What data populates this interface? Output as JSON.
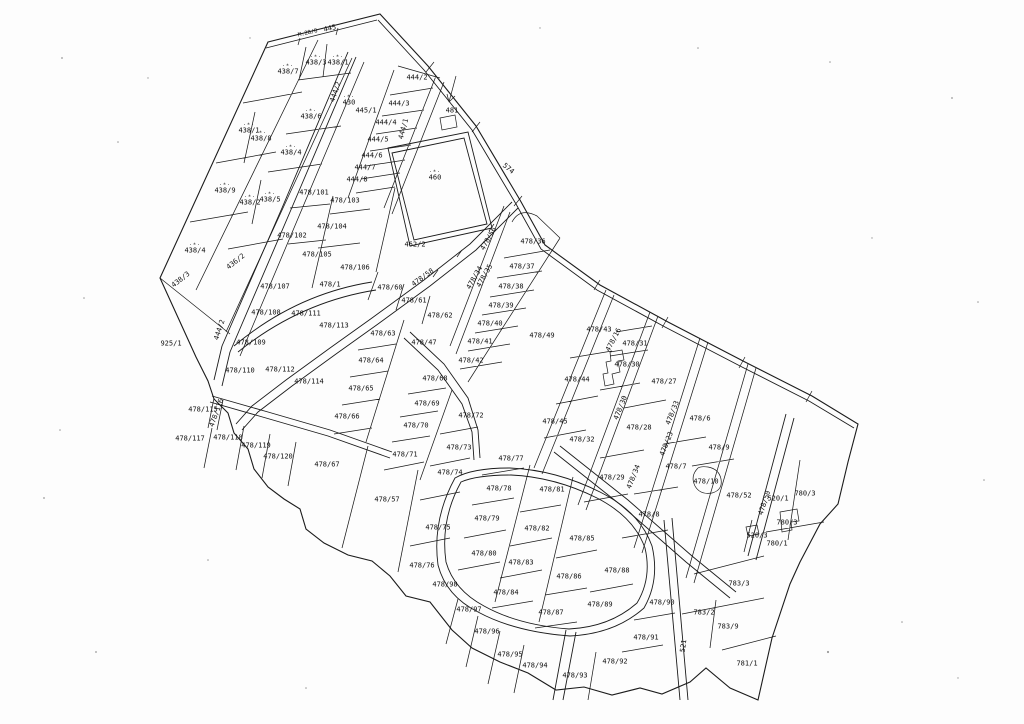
{
  "map": {
    "type": "cadastral-parcel-plan",
    "canvas": {
      "width": 1024,
      "height": 724
    },
    "colors": {
      "background": "#fdfdfd",
      "line": "#1b1b1b",
      "label": "#101010"
    },
    "tree_symbol": "·*·",
    "labels": [
      {
        "t": "445",
        "x": 330,
        "y": 29,
        "r": -13
      },
      {
        "t": "M.28/8",
        "x": 308,
        "y": 34,
        "r": -13,
        "fs": 5.5
      },
      {
        "t": "438/3",
        "x": 316,
        "y": 61,
        "s": 1
      },
      {
        "t": "438/1",
        "x": 338,
        "y": 61,
        "s": 1
      },
      {
        "t": "438/7",
        "x": 288,
        "y": 70,
        "s": 1
      },
      {
        "t": "444/2",
        "x": 336,
        "y": 92,
        "r": -72
      },
      {
        "t": "430",
        "x": 349,
        "y": 101,
        "s": 1
      },
      {
        "t": "438/6",
        "x": 311,
        "y": 115,
        "s": 1
      },
      {
        "t": "445/1",
        "x": 366,
        "y": 111
      },
      {
        "t": "444/2",
        "x": 417,
        "y": 78
      },
      {
        "t": "444/3",
        "x": 399,
        "y": 104
      },
      {
        "t": "444/1",
        "x": 404,
        "y": 129,
        "r": -75
      },
      {
        "t": "444/4",
        "x": 386,
        "y": 123
      },
      {
        "t": "444/5",
        "x": 378,
        "y": 140
      },
      {
        "t": "444/6",
        "x": 372,
        "y": 156
      },
      {
        "t": "444/7",
        "x": 365,
        "y": 168
      },
      {
        "t": "444/8",
        "x": 357,
        "y": 180
      },
      {
        "t": "438/1",
        "x": 249,
        "y": 129,
        "s": 1
      },
      {
        "t": "438/8",
        "x": 261,
        "y": 137,
        "s": 1
      },
      {
        "t": "438/4",
        "x": 291,
        "y": 151,
        "s": 1
      },
      {
        "t": "438/9",
        "x": 225,
        "y": 189,
        "s": 1
      },
      {
        "t": "438/5",
        "x": 270,
        "y": 198,
        "s": 1
      },
      {
        "t": "438/2",
        "x": 250,
        "y": 201,
        "s": 1
      },
      {
        "t": "438/4",
        "x": 195,
        "y": 249,
        "s": 1
      },
      {
        "t": "436/2",
        "x": 236,
        "y": 262,
        "r": -38
      },
      {
        "t": "438/3",
        "x": 181,
        "y": 280,
        "r": -38
      },
      {
        "t": "481",
        "x": 452,
        "y": 111
      },
      {
        "t": "574",
        "x": 508,
        "y": 169,
        "r": 40
      },
      {
        "t": "460",
        "x": 435,
        "y": 176,
        "s": 1
      },
      {
        "t": "462/2",
        "x": 415,
        "y": 245
      },
      {
        "t": "478/101",
        "x": 314,
        "y": 193
      },
      {
        "t": "478/103",
        "x": 345,
        "y": 201
      },
      {
        "t": "478/104",
        "x": 332,
        "y": 227
      },
      {
        "t": "478/102",
        "x": 292,
        "y": 236
      },
      {
        "t": "478/105",
        "x": 317,
        "y": 255
      },
      {
        "t": "478/106",
        "x": 355,
        "y": 268
      },
      {
        "t": "478/56",
        "x": 489,
        "y": 239,
        "r": -60
      },
      {
        "t": "478/34",
        "x": 475,
        "y": 278,
        "r": -60
      },
      {
        "t": "478/35",
        "x": 485,
        "y": 276,
        "r": -60
      },
      {
        "t": "478/58",
        "x": 423,
        "y": 278,
        "r": -36
      },
      {
        "t": "478/36",
        "x": 533,
        "y": 242
      },
      {
        "t": "478/37",
        "x": 522,
        "y": 267
      },
      {
        "t": "478/38",
        "x": 511,
        "y": 287
      },
      {
        "t": "478/39",
        "x": 501,
        "y": 306
      },
      {
        "t": "478/40",
        "x": 490,
        "y": 324
      },
      {
        "t": "478/41",
        "x": 480,
        "y": 342
      },
      {
        "t": "478/42",
        "x": 471,
        "y": 361
      },
      {
        "t": "478/49",
        "x": 542,
        "y": 336
      },
      {
        "t": "478/43",
        "x": 599,
        "y": 330
      },
      {
        "t": "478/16",
        "x": 614,
        "y": 340,
        "r": -62
      },
      {
        "t": "478/31",
        "x": 635,
        "y": 344
      },
      {
        "t": "478/30",
        "x": 627,
        "y": 365
      },
      {
        "t": "478/27",
        "x": 664,
        "y": 382
      },
      {
        "t": "478/44",
        "x": 577,
        "y": 380
      },
      {
        "t": "478/28",
        "x": 639,
        "y": 428
      },
      {
        "t": "478/45",
        "x": 555,
        "y": 422
      },
      {
        "t": "478/32",
        "x": 582,
        "y": 440
      },
      {
        "t": "478/29",
        "x": 612,
        "y": 478
      },
      {
        "t": "478/30",
        "x": 621,
        "y": 408,
        "r": -68
      },
      {
        "t": "478/33",
        "x": 673,
        "y": 413,
        "r": -68
      },
      {
        "t": "478/23",
        "x": 667,
        "y": 444,
        "r": -68
      },
      {
        "t": "478/34",
        "x": 634,
        "y": 477,
        "r": -68
      },
      {
        "t": "478/6",
        "x": 700,
        "y": 419
      },
      {
        "t": "478/9",
        "x": 719,
        "y": 448
      },
      {
        "t": "478/7",
        "x": 676,
        "y": 467
      },
      {
        "t": "478/10",
        "x": 706,
        "y": 482
      },
      {
        "t": "478/8",
        "x": 649,
        "y": 515
      },
      {
        "t": "478/52",
        "x": 739,
        "y": 496
      },
      {
        "t": "478/50",
        "x": 765,
        "y": 503,
        "r": -72
      },
      {
        "t": "520/1",
        "x": 778,
        "y": 499
      },
      {
        "t": "780/3",
        "x": 805,
        "y": 494
      },
      {
        "t": "780/3",
        "x": 787,
        "y": 523
      },
      {
        "t": "780/1",
        "x": 777,
        "y": 544
      },
      {
        "t": "520/3",
        "x": 757,
        "y": 536
      },
      {
        "t": "925/1",
        "x": 171,
        "y": 344
      },
      {
        "t": "444/2",
        "x": 220,
        "y": 330,
        "r": -72
      },
      {
        "t": "478/1",
        "x": 330,
        "y": 285
      },
      {
        "t": "478/60",
        "x": 390,
        "y": 288
      },
      {
        "t": "478/61",
        "x": 414,
        "y": 301
      },
      {
        "t": "478/62",
        "x": 440,
        "y": 316
      },
      {
        "t": "478/107",
        "x": 275,
        "y": 287
      },
      {
        "t": "478/108",
        "x": 266,
        "y": 313
      },
      {
        "t": "478/111",
        "x": 306,
        "y": 314
      },
      {
        "t": "478/113",
        "x": 334,
        "y": 326
      },
      {
        "t": "478/109",
        "x": 251,
        "y": 343
      },
      {
        "t": "478/63",
        "x": 383,
        "y": 334
      },
      {
        "t": "478/64",
        "x": 371,
        "y": 361
      },
      {
        "t": "478/110",
        "x": 240,
        "y": 371
      },
      {
        "t": "478/112",
        "x": 280,
        "y": 370
      },
      {
        "t": "478/114",
        "x": 309,
        "y": 382
      },
      {
        "t": "478/65",
        "x": 361,
        "y": 389
      },
      {
        "t": "478/47",
        "x": 424,
        "y": 343
      },
      {
        "t": "478/68",
        "x": 435,
        "y": 379
      },
      {
        "t": "478/69",
        "x": 427,
        "y": 404
      },
      {
        "t": "478/70",
        "x": 416,
        "y": 426
      },
      {
        "t": "478/72",
        "x": 471,
        "y": 416
      },
      {
        "t": "478/66",
        "x": 347,
        "y": 417
      },
      {
        "t": "478/115",
        "x": 203,
        "y": 410
      },
      {
        "t": "478/116",
        "x": 217,
        "y": 413,
        "r": -70
      },
      {
        "t": "478/117",
        "x": 190,
        "y": 439
      },
      {
        "t": "478/118",
        "x": 228,
        "y": 438
      },
      {
        "t": "478/119",
        "x": 256,
        "y": 446
      },
      {
        "t": "478/120",
        "x": 278,
        "y": 457
      },
      {
        "t": "478/67",
        "x": 327,
        "y": 465
      },
      {
        "t": "478/71",
        "x": 405,
        "y": 455
      },
      {
        "t": "478/73",
        "x": 459,
        "y": 448
      },
      {
        "t": "478/74",
        "x": 450,
        "y": 473
      },
      {
        "t": "478/57",
        "x": 387,
        "y": 500
      },
      {
        "t": "478/75",
        "x": 438,
        "y": 528
      },
      {
        "t": "478/76",
        "x": 422,
        "y": 566
      },
      {
        "t": "478/77",
        "x": 511,
        "y": 459
      },
      {
        "t": "478/78",
        "x": 499,
        "y": 489
      },
      {
        "t": "478/79",
        "x": 487,
        "y": 519
      },
      {
        "t": "478/80",
        "x": 484,
        "y": 554
      },
      {
        "t": "478/81",
        "x": 552,
        "y": 490
      },
      {
        "t": "478/82",
        "x": 537,
        "y": 529
      },
      {
        "t": "478/83",
        "x": 521,
        "y": 563
      },
      {
        "t": "478/84",
        "x": 506,
        "y": 593
      },
      {
        "t": "478/85",
        "x": 582,
        "y": 539
      },
      {
        "t": "478/86",
        "x": 569,
        "y": 577
      },
      {
        "t": "478/87",
        "x": 551,
        "y": 613
      },
      {
        "t": "478/88",
        "x": 617,
        "y": 571
      },
      {
        "t": "478/89",
        "x": 600,
        "y": 605
      },
      {
        "t": "478/90",
        "x": 662,
        "y": 603
      },
      {
        "t": "478/91",
        "x": 646,
        "y": 638
      },
      {
        "t": "478/92",
        "x": 615,
        "y": 662
      },
      {
        "t": "478/93",
        "x": 575,
        "y": 676
      },
      {
        "t": "478/94",
        "x": 535,
        "y": 666
      },
      {
        "t": "478/95",
        "x": 510,
        "y": 655
      },
      {
        "t": "478/96",
        "x": 487,
        "y": 632
      },
      {
        "t": "478/97",
        "x": 469,
        "y": 610
      },
      {
        "t": "478/98",
        "x": 445,
        "y": 585
      },
      {
        "t": "521",
        "x": 684,
        "y": 646,
        "r": -82
      },
      {
        "t": "783/3",
        "x": 739,
        "y": 584
      },
      {
        "t": "783/2",
        "x": 704,
        "y": 613
      },
      {
        "t": "783/9",
        "x": 728,
        "y": 627
      },
      {
        "t": "781/1",
        "x": 747,
        "y": 664
      }
    ]
  }
}
